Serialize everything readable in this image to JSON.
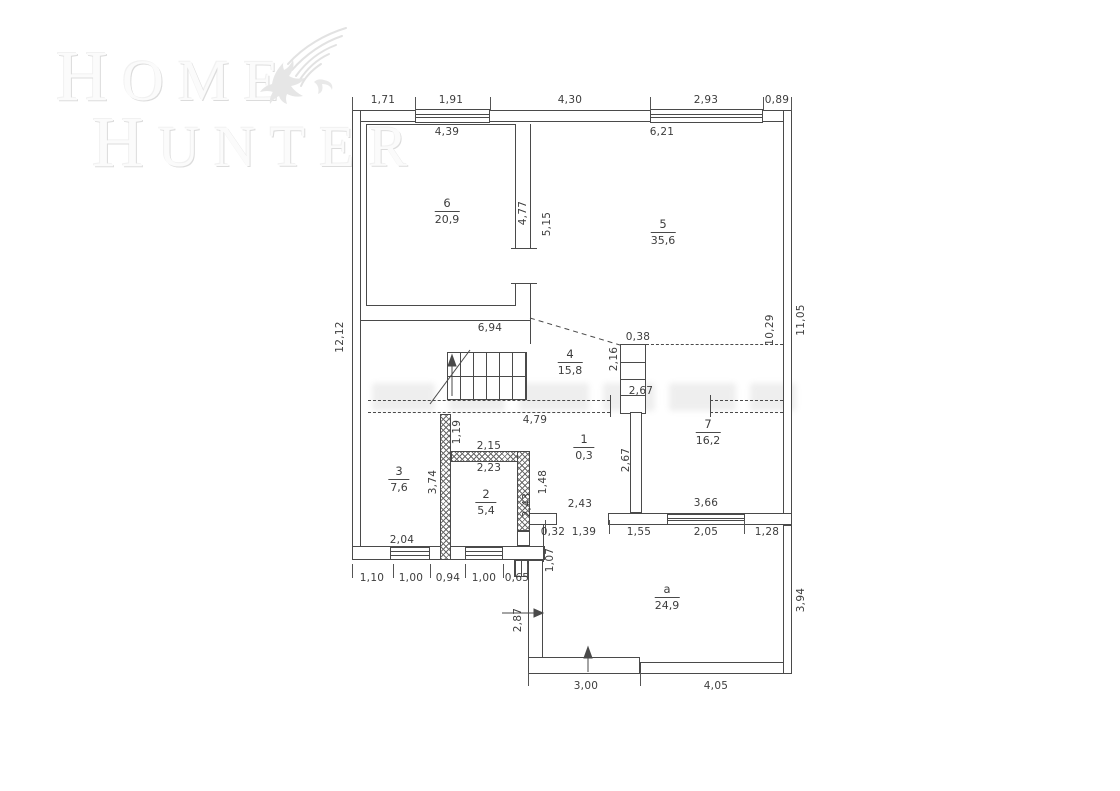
{
  "brand": {
    "line1": "HOME",
    "line2": "HUNTER",
    "logo_icon": "eagle-icon"
  },
  "floorplan": {
    "rooms": [
      {
        "number": "6",
        "area": "20,9"
      },
      {
        "number": "5",
        "area": "35,6"
      },
      {
        "number": "4",
        "area": "15,8"
      },
      {
        "number": "1",
        "area": "0,3"
      },
      {
        "number": "3",
        "area": "7,6"
      },
      {
        "number": "2",
        "area": "5,4"
      },
      {
        "number": "7",
        "area": "16,2"
      },
      {
        "number": "a",
        "area": "24,9"
      }
    ],
    "dimensions": {
      "top_row": [
        "1,71",
        "1,91",
        "4,30",
        "2,93",
        "0,89"
      ],
      "inner_top": {
        "room6": "4,39",
        "room5": "6,21"
      },
      "left_outer": "12,12",
      "room6_right": {
        "inner": "4,77",
        "outer": "5,15"
      },
      "right_side": {
        "inner": "10,29",
        "outer": "11,05"
      },
      "hall": {
        "width": "6,94",
        "column": "0,38",
        "shaft": "2,16",
        "door": "2,67",
        "corridor": "4,79"
      },
      "room1": {
        "height": "2,67"
      },
      "room3": {
        "wall_upper": "1,19",
        "wall": "3,74",
        "width": "2,04"
      },
      "room2": {
        "top_outer": "2,15",
        "top_inner": "2,23",
        "right_upper": "1,48",
        "right": "2,43"
      },
      "room7": {
        "left_gap": "2,43",
        "width": "3,66"
      },
      "mid_row": [
        "0,32",
        "1,39",
        "1,55",
        "2,05",
        "1,28"
      ],
      "bottom_row": [
        "1,10",
        "1,00",
        "0,94",
        "1,00",
        "0,65"
      ],
      "porch": {
        "left_upper": "1,07",
        "left": "2,87",
        "right": "3,94",
        "step": "3,00",
        "bottom": "4,05"
      }
    }
  }
}
